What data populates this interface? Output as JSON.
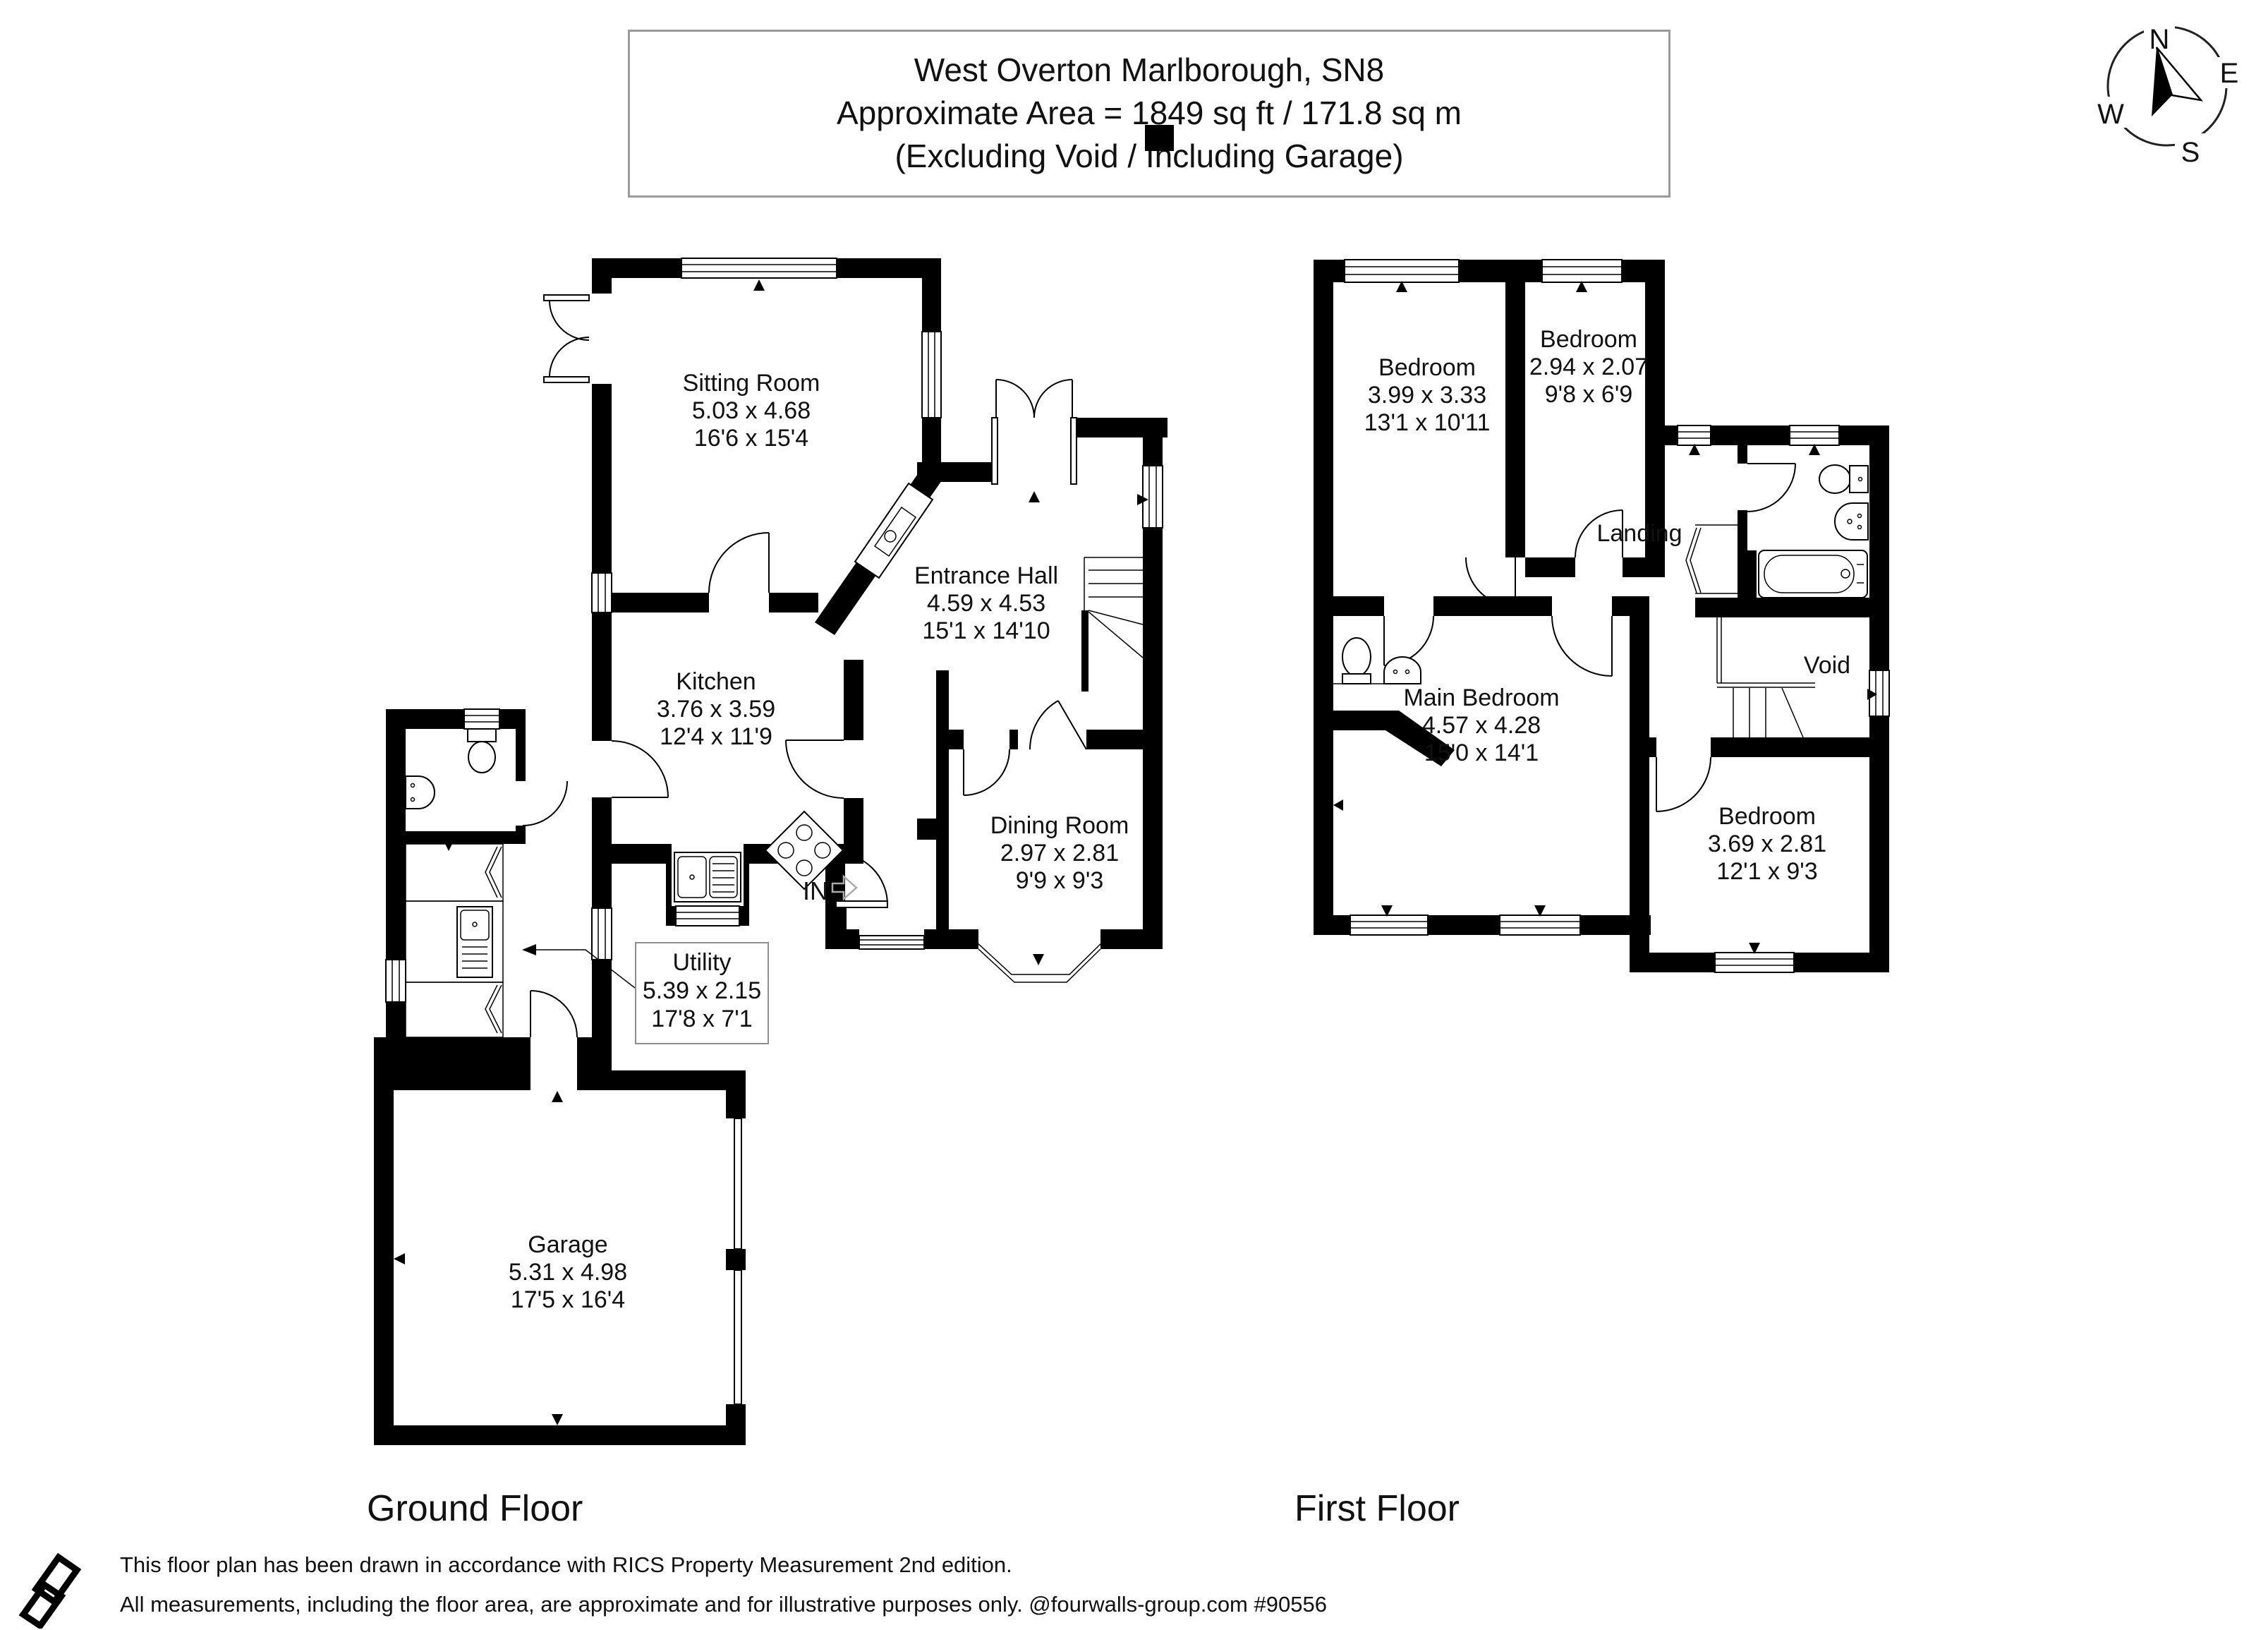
{
  "title_box": {
    "line1": "West Overton Marlborough, SN8",
    "line2": "Approximate Area = 1849 sq ft / 171.8 sq m",
    "line3": "(Excluding Void / Including Garage)"
  },
  "compass": {
    "north": "N",
    "east": "E",
    "south": "S",
    "west": "W"
  },
  "ground_floor": {
    "caption": "Ground Floor",
    "entrance_label": "IN",
    "rooms": [
      {
        "id": "sitting-room",
        "name": "Sitting Room",
        "metric": "5.03 x 4.68",
        "imperial": "16'6 x 15'4"
      },
      {
        "id": "entrance-hall",
        "name": "Entrance Hall",
        "metric": "4.59 x 4.53",
        "imperial": "15'1 x 14'10"
      },
      {
        "id": "kitchen",
        "name": "Kitchen",
        "metric": "3.76 x 3.59",
        "imperial": "12'4 x 11'9"
      },
      {
        "id": "dining-room",
        "name": "Dining Room",
        "metric": "2.97 x 2.81",
        "imperial": "9'9 x 9'3"
      },
      {
        "id": "utility",
        "name": "Utility",
        "metric": "5.39 x 2.15",
        "imperial": "17'8 x 7'1"
      },
      {
        "id": "garage",
        "name": "Garage",
        "metric": "5.31 x 4.98",
        "imperial": "17'5 x 16'4"
      }
    ]
  },
  "first_floor": {
    "caption": "First Floor",
    "rooms": [
      {
        "id": "bedroom-1",
        "name": "Bedroom",
        "metric": "3.99 x 3.33",
        "imperial": "13'1 x 10'11"
      },
      {
        "id": "bedroom-2",
        "name": "Bedroom",
        "metric": "2.94 x 2.07",
        "imperial": "9'8 x 6'9"
      },
      {
        "id": "main-bedroom",
        "name": "Main Bedroom",
        "metric": "4.57 x 4.28",
        "imperial": "15'0 x 14'1"
      },
      {
        "id": "bedroom-3",
        "name": "Bedroom",
        "metric": "3.69 x 2.81",
        "imperial": "12'1 x 9'3"
      },
      {
        "id": "landing",
        "name": "Landing"
      },
      {
        "id": "void",
        "name": "Void"
      }
    ]
  },
  "footer": {
    "line1": "This floor plan has been drawn in accordance with RICS Property Measurement 2nd edition.",
    "line2": "All measurements, including the floor area, are approximate and for illustrative purposes only. @fourwalls-group.com #90556"
  },
  "colors": {
    "walls": "#000000",
    "text": "#111111",
    "title_border": "#9a9a9a",
    "arrow_gray": "#aaaaaa"
  }
}
